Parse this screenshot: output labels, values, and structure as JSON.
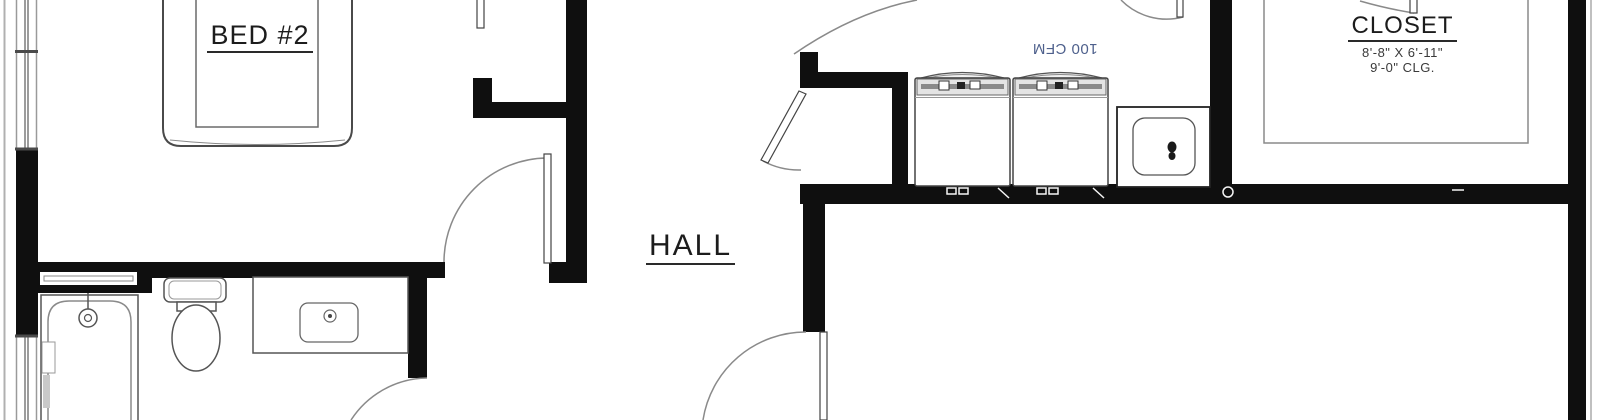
{
  "rooms": {
    "bed2": {
      "label": "BED #2"
    },
    "hall": {
      "label": "HALL"
    },
    "closet": {
      "label": "CLOSET",
      "dimensions": "8'-8\" X 6'-11\"",
      "ceiling": "9'-0\" CLG."
    }
  },
  "annotations": {
    "exhaust_fan": {
      "label": "100 CFM",
      "rotation_deg": 180,
      "color": "#4e608c"
    }
  },
  "colors": {
    "wall": "#0f0f0f",
    "fixture_line": "#555555",
    "light_line": "#999999",
    "background": "#ffffff"
  },
  "fixtures": {
    "bathroom": [
      "bathtub",
      "toilet",
      "vanity-sink"
    ],
    "laundry": [
      "washer",
      "washer",
      "laundry-sink"
    ],
    "bedroom": [
      "bed"
    ]
  }
}
